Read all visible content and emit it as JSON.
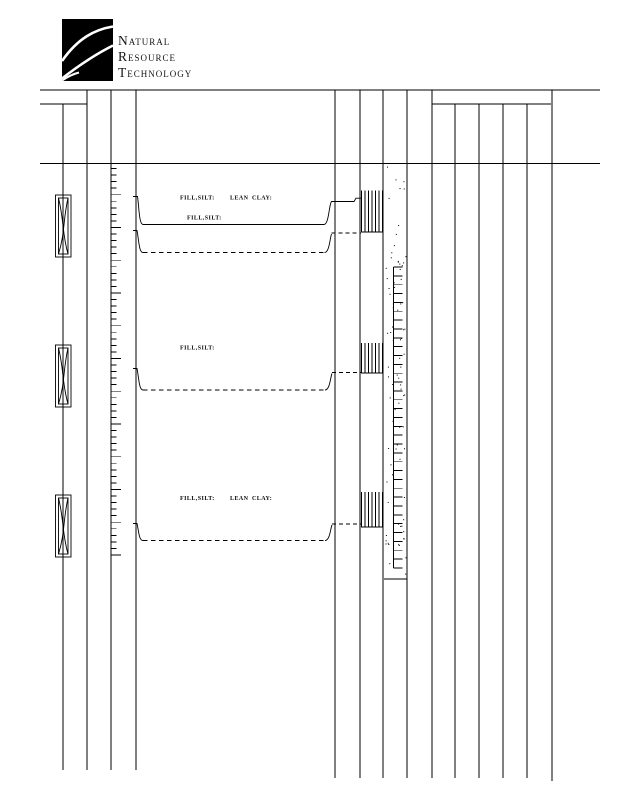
{
  "company": {
    "name_line1": "Natural",
    "name_line2": "Resource",
    "name_line3": "Technology"
  },
  "drawing": {
    "labels": {
      "fill_silt": "FILL,SILT:",
      "lean": "LEAN",
      "clay": "CLAY:"
    },
    "colors": {
      "ink": "#000000",
      "paper": "#ffffff"
    }
  }
}
